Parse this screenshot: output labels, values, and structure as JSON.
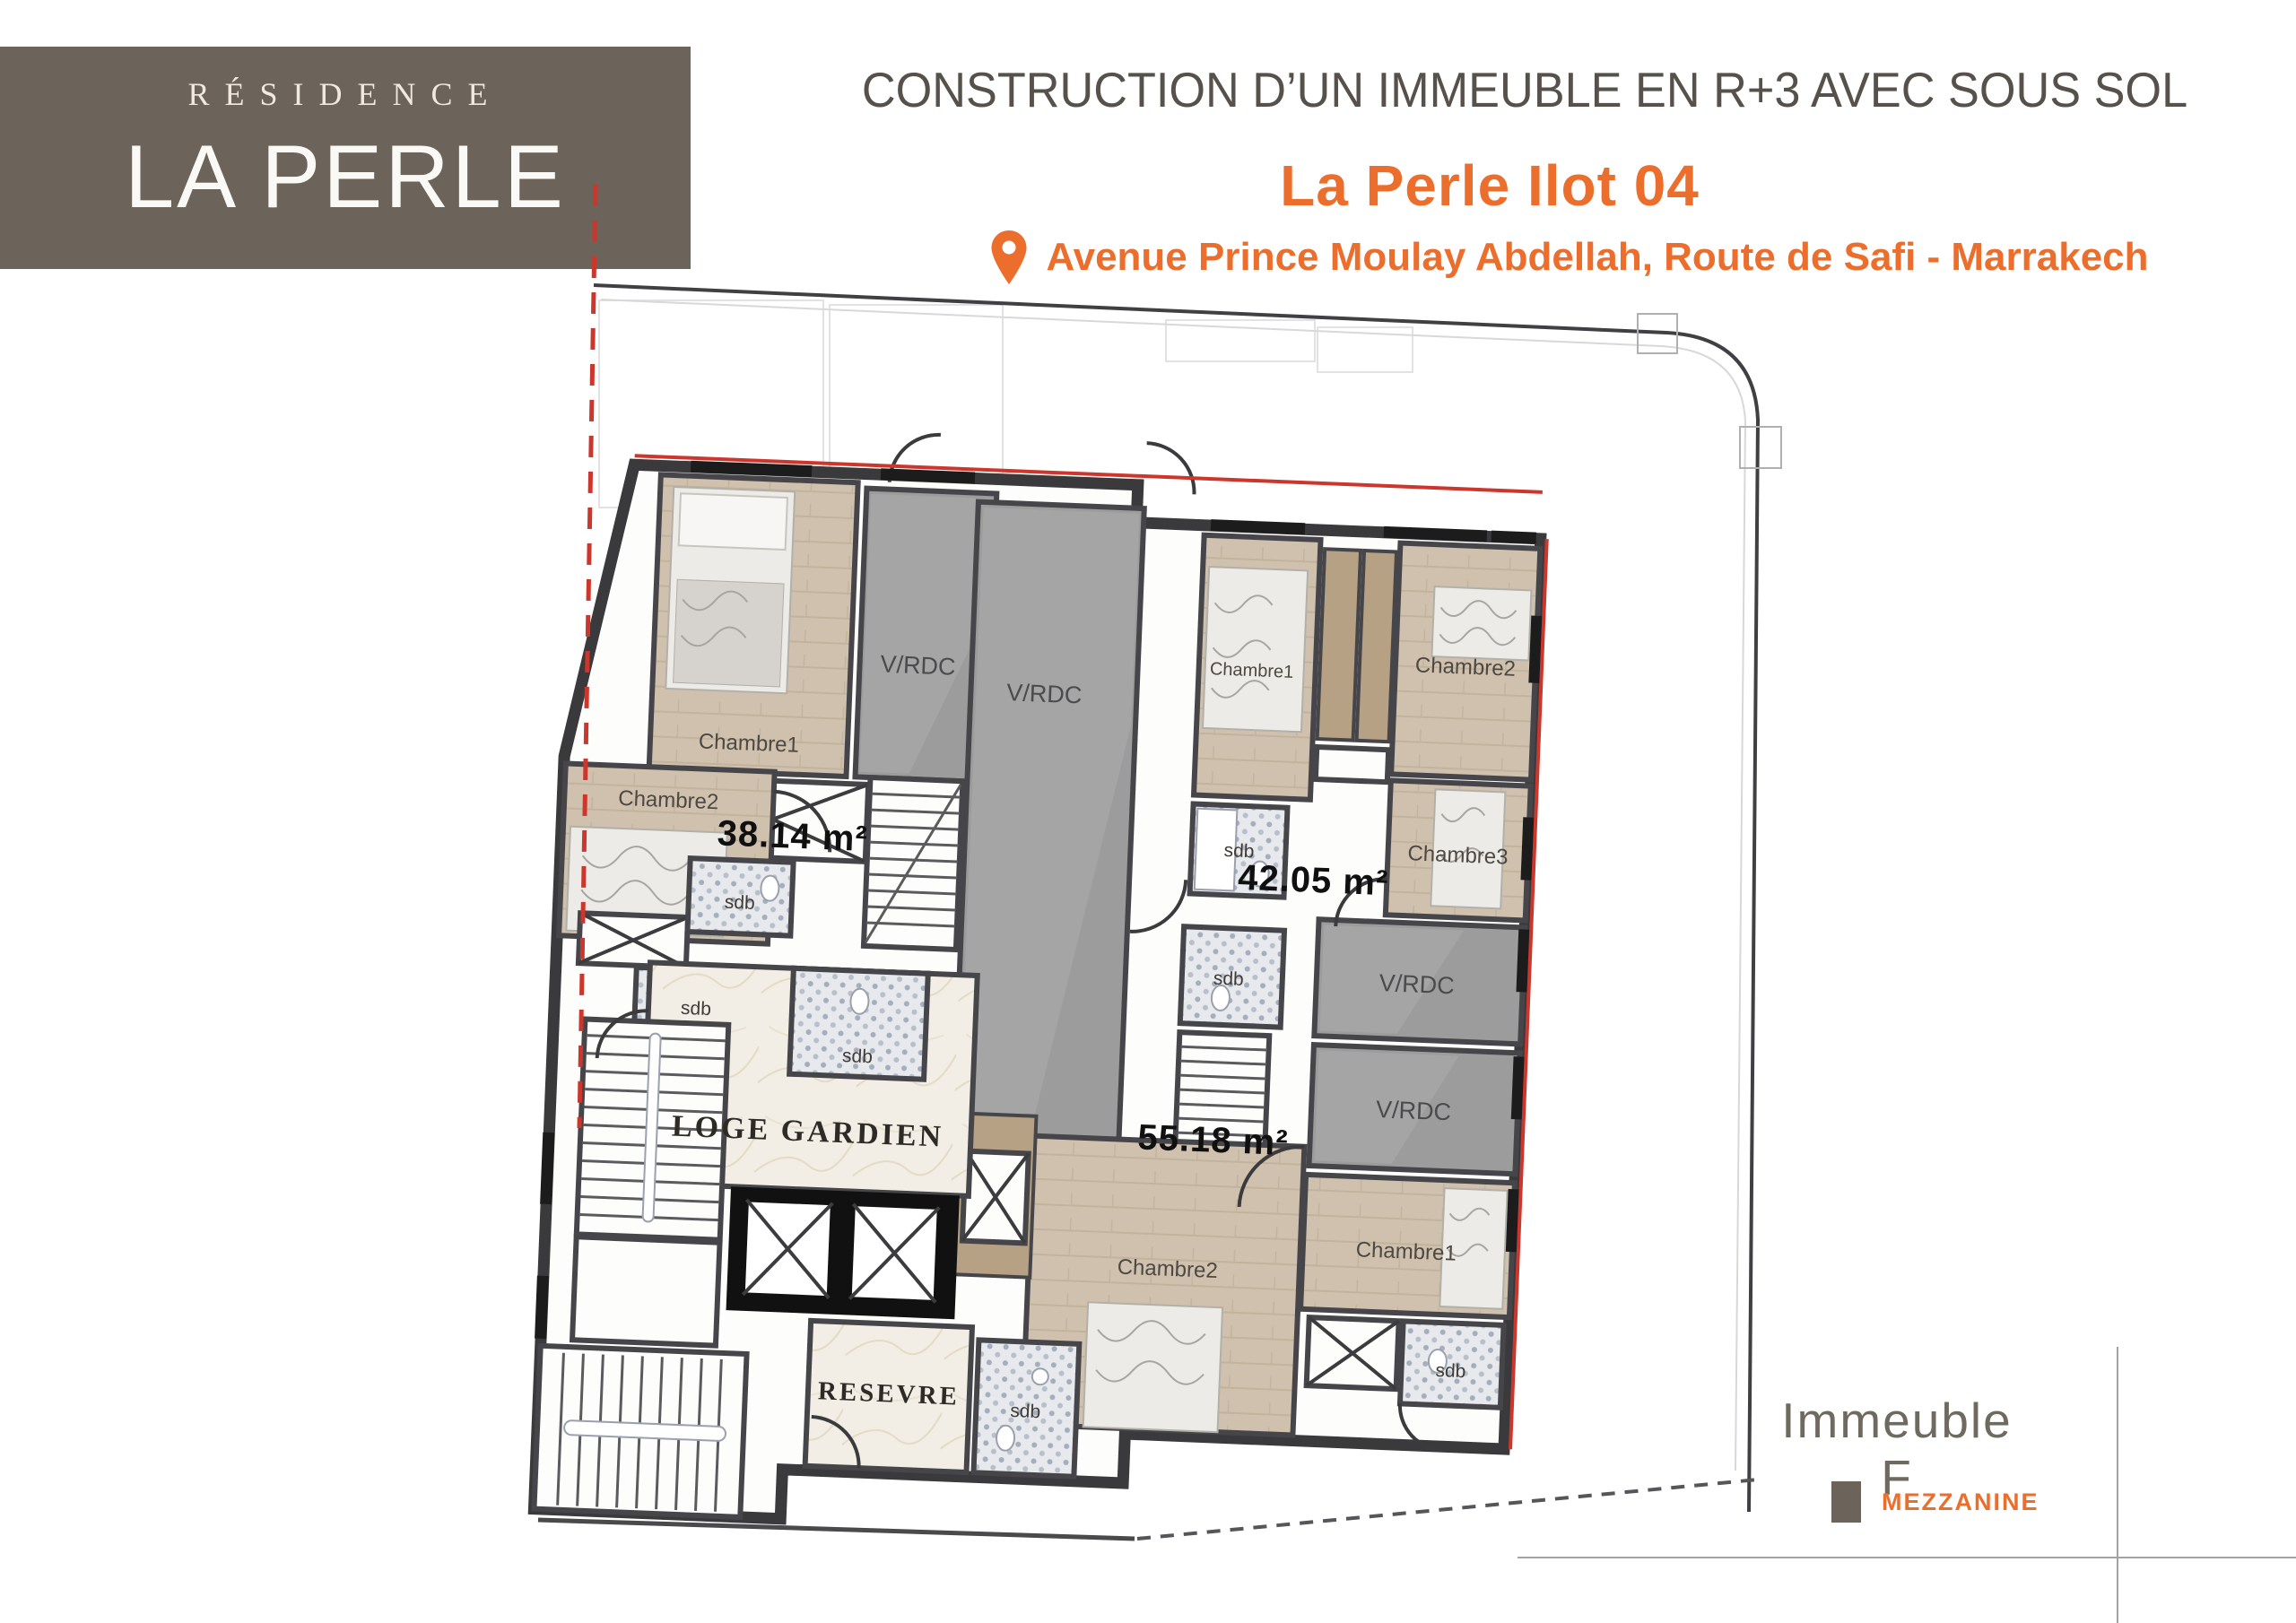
{
  "logo": {
    "residence": "RÉSIDENCE",
    "name": "LA PERLE"
  },
  "header": {
    "title": "CONSTRUCTION D’UN IMMEUBLE EN R+3 AVEC SOUS SOL",
    "project": "La Perle Ilot 04",
    "address": "Avenue Prince Moulay Abdellah, Route de Safi - Marrakech"
  },
  "plan": {
    "floor": "RDC / Mezzanine",
    "apartments": [
      {
        "id": "apt-left",
        "area": "38.14 m²"
      },
      {
        "id": "apt-right",
        "area": "42.05 m²"
      },
      {
        "id": "apt-bottom",
        "area": "55.18 m²"
      }
    ],
    "labels": {
      "chambre1": "Chambre1",
      "chambre2": "Chambre2",
      "chambre3": "Chambre3",
      "vrdc": "V/RDC",
      "sdb": "sdb",
      "loge": "LOGE GARDIEN",
      "reserve": "RESEVRE"
    }
  },
  "footer": {
    "building": "Immeuble F",
    "legend_mezzanine": "MEZZANINE"
  },
  "colors": {
    "accent_orange": "#ec6e2d",
    "brand_brown": "#6c645a",
    "boundary_red": "#cb372d",
    "vrdc_gray": "#9c9c9c",
    "floor_tan": "#cfc1ae"
  }
}
